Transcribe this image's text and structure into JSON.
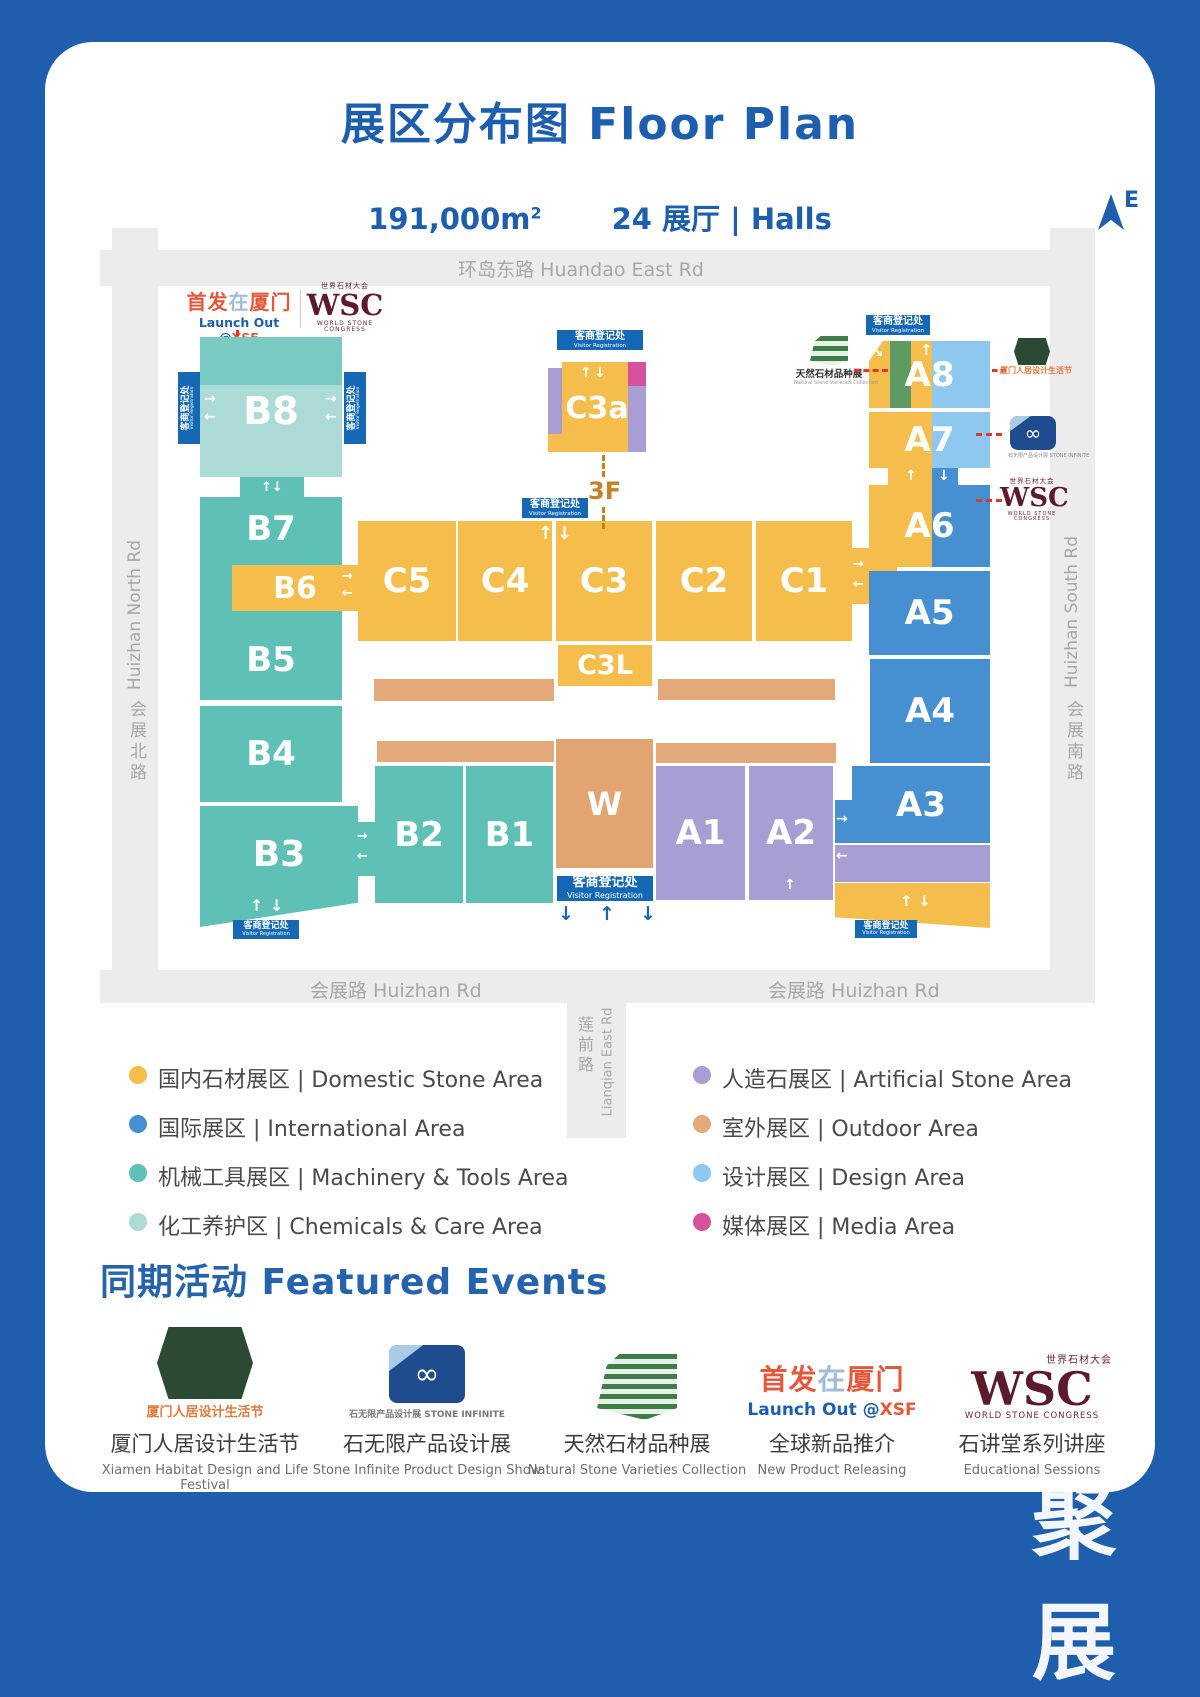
{
  "header": {
    "title": "展区分布图 Floor Plan",
    "area": "191,000m",
    "area_sup": "2",
    "halls": "24 展厅 | Halls",
    "compass_e": "E"
  },
  "roads": {
    "top": "环岛东路  Huandao East Rd",
    "left_en": "Huizhan North Rd",
    "left_cn": "会展北路",
    "right_en": "Huizhan South Rd",
    "right_cn": "会展南路",
    "bottom": "会展路  Huizhan Rd",
    "lianqian_cn": "莲前路",
    "lianqian_en": "Lianqian East Rd"
  },
  "registration": {
    "cn": "客商登记处",
    "en": "Visitor Registration"
  },
  "floor_label": "3F",
  "halls": {
    "b8": "B8",
    "b7": "B7",
    "b6": "B6",
    "b5": "B5",
    "b4": "B4",
    "b3": "B3",
    "b2": "B2",
    "b1": "B1",
    "c5": "C5",
    "c4": "C4",
    "c3": "C3",
    "c2": "C2",
    "c1": "C1",
    "c3a": "C3a",
    "c3l": "C3L",
    "w": "W",
    "a1": "A1",
    "a2": "A2",
    "a3": "A3",
    "a4": "A4",
    "a5": "A5",
    "a6": "A6",
    "a7": "A7",
    "a8": "A8"
  },
  "logos": {
    "xsf_p1": "首发",
    "xsf_p2": "在",
    "xsf_p3": "厦门",
    "xsf_sub_a": "Launch Out @",
    "xsf_sub_b": "XSF",
    "wsc_cn": "世界石材大会",
    "wsc": "WSC",
    "wsc_sub": "WORLD STONE CONGRESS",
    "natural_cn": "天然石材品种展",
    "natural_en": "Natural Stone Varieties Collection",
    "xiamen_cn": "厦门人居设计生活节",
    "infinite_caption": "石无限产品设计展 STONE INFINITE"
  },
  "legend": {
    "left": [
      {
        "label": "国内石材展区 | Domestic Stone Area",
        "color": "#F5BE4C"
      },
      {
        "label": "国际展区 | International Area",
        "color": "#4690D2"
      },
      {
        "label": "机械工具展区 | Machinery & Tools Area",
        "color": "#5FC0B6"
      },
      {
        "label": "化工养护区 | Chemicals & Care Area",
        "color": "#ACDBD7"
      }
    ],
    "right": [
      {
        "label": "人造石展区 | Artificial Stone Area",
        "color": "#A99ED3"
      },
      {
        "label": "室外展区 | Outdoor Area",
        "color": "#E3A97B"
      },
      {
        "label": "设计展区 | Design Area",
        "color": "#8FC8EF"
      },
      {
        "label": "媒体展区 | Media Area",
        "color": "#D5509D"
      }
    ]
  },
  "events": {
    "title": "同期活动 Featured Events",
    "items": [
      {
        "cn": "厦门人居设计生活节",
        "en": "Xiamen Habitat Design and Life Festival",
        "logo_caption": "厦门人居设计生活节"
      },
      {
        "cn": "石无限产品设计展",
        "en": "Stone Infinite Product Design Show",
        "logo_caption": "石无限产品设计展 STONE INFINITE"
      },
      {
        "cn": "天然石材品种展",
        "en": "Natural Stone Varieties Collection"
      },
      {
        "cn": "全球新品推介",
        "en": "New Product Releasing"
      },
      {
        "cn": "石讲堂系列讲座",
        "en": "Educational Sessions"
      }
    ]
  },
  "icons": {
    "up": "↑",
    "down": "↓",
    "left": "←",
    "right": "→",
    "diag": "↘",
    "infinity": "∞"
  },
  "watermark": "聚展"
}
